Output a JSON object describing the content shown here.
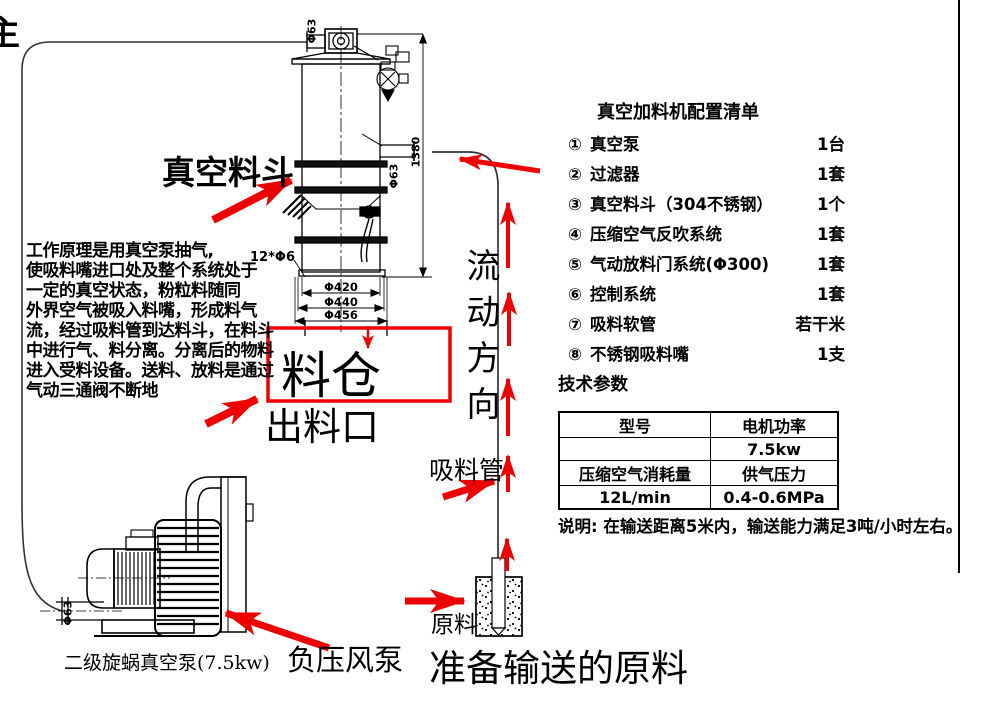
{
  "page": {
    "clipped_edge_char": "主",
    "annotation_color": "#ee0000",
    "line_color": "#000000"
  },
  "diagram": {
    "hopper_label": "真空料斗",
    "silo_label": "料仓",
    "outlet_label": "出料口",
    "flow_direction_label": "流动方向",
    "suction_pipe_label": "吸料管",
    "raw_material_label": "原料",
    "raw_material_caption": "准备输送的原料",
    "pump_caption": "二级旋蜗真空泵(7.5kw)",
    "fan_label": "负压风泵",
    "dims": {
      "top_pipe": "Φ63",
      "inlet_pipe": "Φ63",
      "pump_inlet": "Φ63",
      "height": "1380",
      "bolt_holes": "12*Φ6",
      "dia1": "Φ420",
      "dia2": "Φ440",
      "dia3": "Φ456"
    }
  },
  "principle": {
    "lines": [
      "工作原理是用真空泵抽气,",
      "使吸料嘴进口处及整个系统处于",
      "一定的真空状态，粉粒料随同",
      "外界空气被吸入料嘴，形成料气",
      "流，经过吸料管到达料斗，在料斗",
      "中进行气、料分离。分离后的物料",
      "进入受料设备。送料、放料是通过",
      "气动三通阀不断地"
    ]
  },
  "config_list": {
    "title": "真空加料机配置清单",
    "items": [
      {
        "num": "①",
        "name": "真空泵",
        "qty": "1台"
      },
      {
        "num": "②",
        "name": "过滤器",
        "qty": "1套"
      },
      {
        "num": "③",
        "name": "真空料斗（304不锈钢）",
        "qty": "1个"
      },
      {
        "num": "④",
        "name": "压缩空气反吹系统",
        "qty": "1套"
      },
      {
        "num": "⑤",
        "name": "气动放料门系统(Φ300)",
        "qty": "1套"
      },
      {
        "num": "⑥",
        "name": "控制系统",
        "qty": "1套"
      },
      {
        "num": "⑦",
        "name": "吸料软管",
        "qty": "若干米"
      },
      {
        "num": "⑧",
        "name": "不锈钢吸料嘴",
        "qty": "1支"
      }
    ]
  },
  "tech_params": {
    "title": "技术参数",
    "table": [
      [
        "型号",
        "电机功率"
      ],
      [
        "",
        "7.5kw"
      ],
      [
        "压缩空气消耗量",
        "供气压力"
      ],
      [
        "12L/min",
        "0.4-0.6MPa"
      ]
    ],
    "note": "说明: 在输送距离5米内，输送能力满足3吨/小时左右。"
  }
}
